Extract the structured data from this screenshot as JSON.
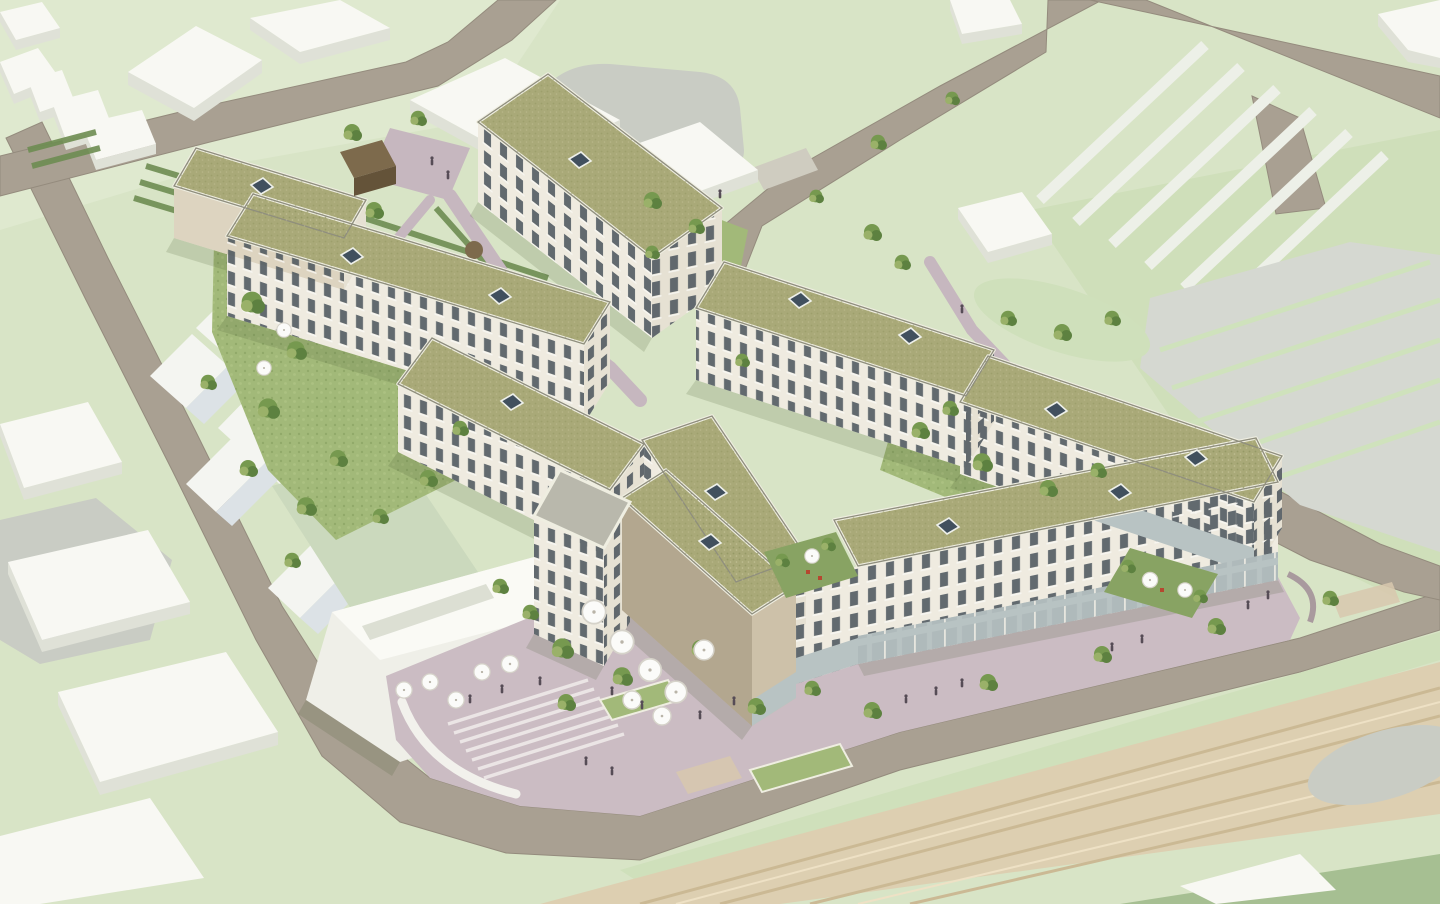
{
  "scene": {
    "image_kind": "3d-architectural-aerial-rendering",
    "description": "Aerial 3D visualization of a new residential quarter: eight cream-coloured apartment blocks with olive-green flat roofs arranged around landscaped courtyards, a pedestrian plaza with cafe umbrellas and broad stairs, a brick-clad corner building with ground-floor retail, white gabled row houses and a market hall to the west, abstract white context massing blocks, striped surface parking grounds to the north-east, a railway corridor along the lower right and warm-grey perimeter roads on light-green ground.",
    "text_content": "none - the rendering contains no visible text, labels or UI elements",
    "features": [
      "eight apartment blocks with olive-green extensive roofs",
      "white roof parapets with skylight domes",
      "balconied cream facades",
      "courtyards with lawns, hedges and trees",
      "mauve pedestrian paving and plaza",
      "cafe umbrellas and people",
      "ground-floor retail glazing along the street front",
      "brick corner building",
      "gabled white row houses and market hall",
      "white context massing blocks",
      "striped parking grounds",
      "railway corridor with parallel tracks",
      "perimeter roads"
    ],
    "counts": {
      "apartment_blocks": 8,
      "roof_skylights": 13,
      "cafe_umbrellas": 17,
      "trees": 48,
      "railway_tracks": 6
    }
  },
  "palette": {
    "bg": "#d8e4c6",
    "bgLight": "#dfe9cf",
    "bgDark": "#cfdfba",
    "road": "#a9a092",
    "roadEdge": "#948b7d",
    "sidewalk": "#cfccc0",
    "slabTop": "#f8f8f3",
    "slabSide": "#dfe1d7",
    "gableLight": "#f4f5f1",
    "gableShade": "#dce2e6",
    "hallRoof": "#cbd9bd",
    "hallRoof2": "#dde7d2",
    "hallWhite": "#efefe8",
    "hallTop": "#fafaf5",
    "roof": "#a9a978",
    "parapet": "#efeee1",
    "roofRim": "#8f8e7e",
    "facade": "#efebe0",
    "facadeShade": "#ded9cc",
    "facadeEnd": "#e6e1d3",
    "facadeTan": "#ddd4c0",
    "window": "#4a545c",
    "sill": "#fafaf7",
    "brickDark": "#b3a78f",
    "brickLight": "#cdc1a9",
    "retailGlass": "#b8c3c3",
    "towerTop": "#b9b8ac",
    "grass": "#a2b979",
    "grassDark": "#88a363",
    "hedge": "#6e8d52",
    "tree1": "#76994f",
    "tree2": "#5d8140",
    "tree3": "#9ab169",
    "path": "#c6b7bf",
    "plaza": "#cbbcc3",
    "stair": "#ebe5e5",
    "ramp": "#f2f1ec",
    "bench": "#a99a9e",
    "rail": "#ddcfb1",
    "railLine": "#cbb994",
    "railLineLight": "#eee1c5",
    "railGreen": "#cfe0bb",
    "parkGray": "#d5d8d1",
    "parkStripe": "#cfe2bc",
    "parkWhite": "#edf0e8",
    "grayBlob": "#c9ccc4",
    "shedTop": "#7d6a4c",
    "shedSide": "#645339",
    "umbrella": "#fbfbf9",
    "umbrellaEdge": "#d6d3ca",
    "skylight": "#41505e",
    "skylightRim": "#eef0ea",
    "person": "#564c56",
    "shadow": "rgba(70,90,45,0.17)",
    "crosswalk": "#d8c8ae",
    "darkCorner": "#a6bf92",
    "planterRed": "#b5472f"
  }
}
